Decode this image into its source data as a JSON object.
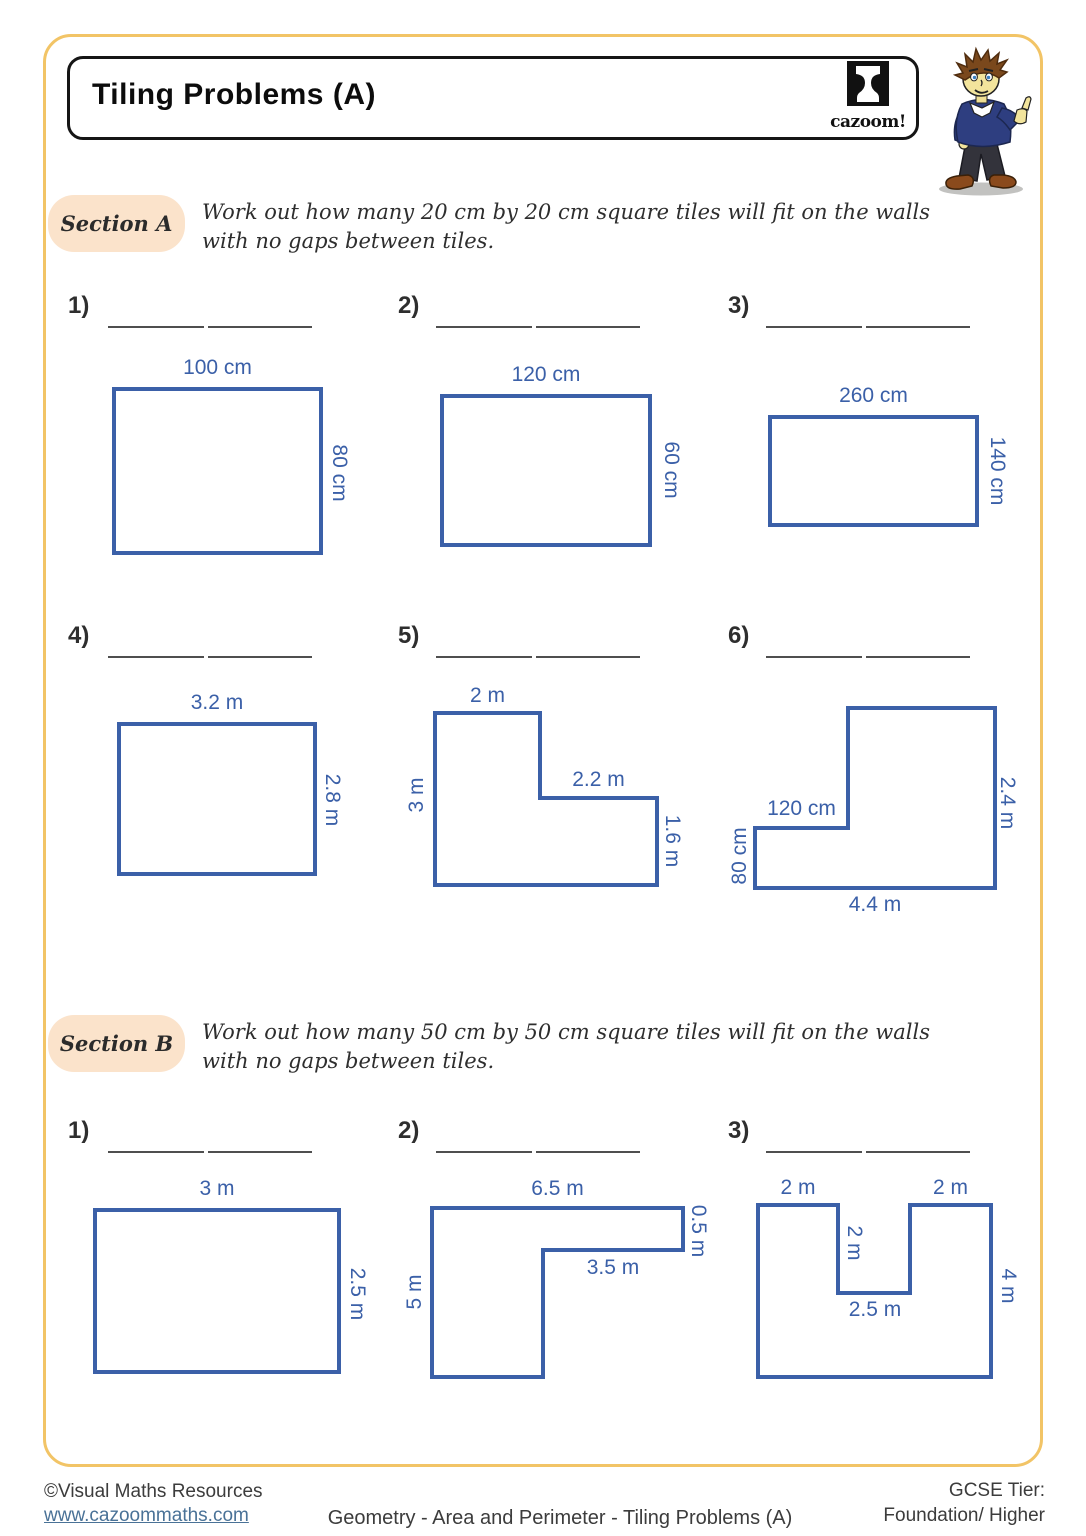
{
  "header": {
    "title": "Tiling Problems (A)",
    "logo_wordmark": "cazoom!"
  },
  "colors": {
    "shape_outline": "#3b60a8",
    "dimension_text": "#3b60a8",
    "frame": "#f2c466",
    "section_pill": "#fbe3cb",
    "link": "#4a7297"
  },
  "sections": {
    "a": {
      "label": "Section A",
      "line1": "Work out how many 20 cm by 20 cm square tiles will fit on the walls",
      "line2": "with no gaps between tiles."
    },
    "b": {
      "label": "Section B",
      "line1": "Work out how many 50 cm by 50 cm square tiles will fit on the walls",
      "line2": "with no gaps between tiles."
    }
  },
  "problems": {
    "a1": {
      "num": "1)",
      "top": "100 cm",
      "right": "80 cm"
    },
    "a2": {
      "num": "2)",
      "top": "120 cm",
      "right": "60 cm"
    },
    "a3": {
      "num": "3)",
      "top": "260 cm",
      "right": "140 cm"
    },
    "a4": {
      "num": "4)",
      "top": "3.2 m",
      "right": "2.8 m"
    },
    "a5": {
      "num": "5)",
      "top": "2 m",
      "left": "3 m",
      "mid": "2.2 m",
      "right": "1.6 m"
    },
    "a6": {
      "num": "6)",
      "step": "120 cm",
      "left": "80 cm",
      "right": "2.4 m",
      "bottom": "4.4 m"
    },
    "b1": {
      "num": "1)",
      "top": "3 m",
      "right": "2.5 m"
    },
    "b2": {
      "num": "2)",
      "top": "6.5 m",
      "right": "0.5 m",
      "mid": "3.5 m",
      "left": "5 m"
    },
    "b3": {
      "num": "3)",
      "top_left": "2 m",
      "top_right": "2 m",
      "notch": "2 m",
      "notch_bottom": "2.5 m",
      "right": "4 m"
    }
  },
  "footer": {
    "copyright": "©Visual Maths Resources",
    "link": "www.cazoommaths.com",
    "center": "Geometry - Area and Perimeter - Tiling Problems (A)",
    "tier_label": "GCSE Tier:",
    "tier_value": "Foundation/ Higher"
  }
}
